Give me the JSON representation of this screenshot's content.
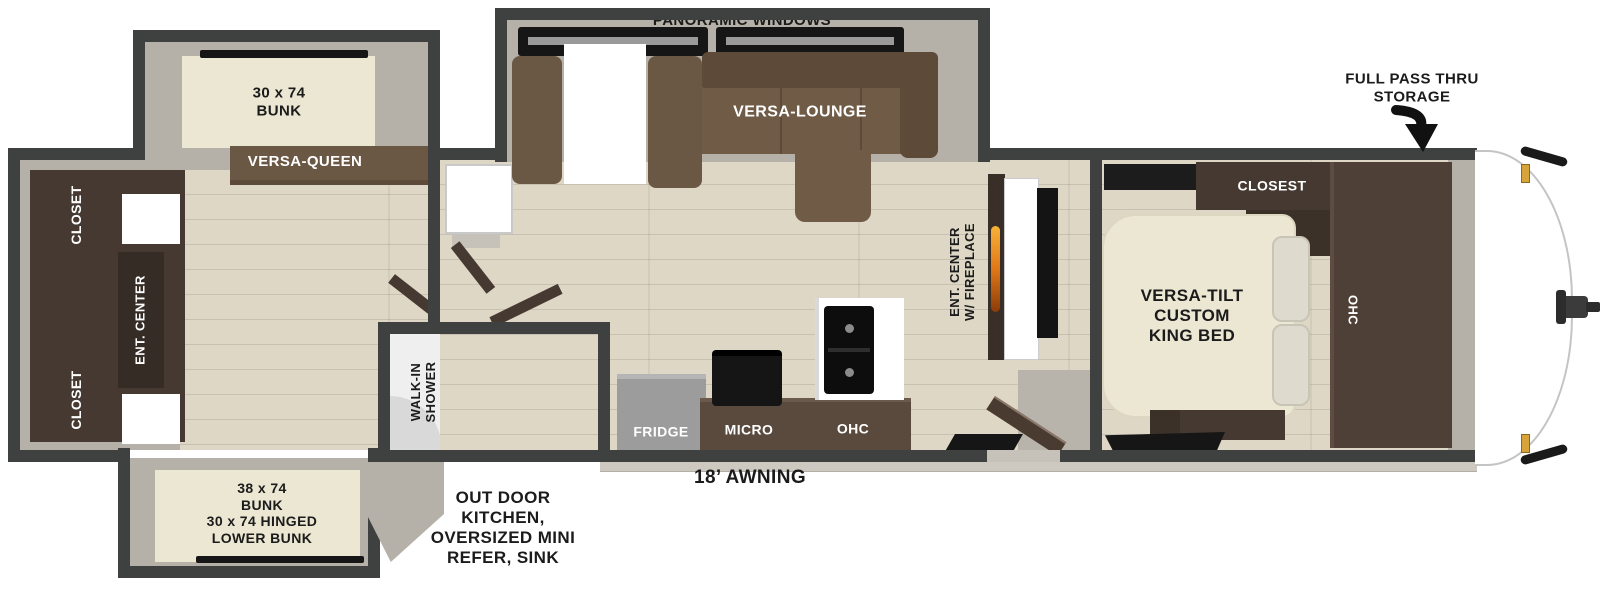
{
  "colors": {
    "wall": "#3f4040",
    "wallFace": "#b5b1a8",
    "floor": "#ded7c5",
    "cream": "#ece7d3",
    "brownDark": "#453931",
    "brown": "#55463b",
    "brownMid": "#6b5844",
    "sofa": "#6f5b46",
    "sofaDark": "#5d4a39",
    "applianceGray": "#9c9c9c",
    "black": "#161616",
    "glass": "#9fbdb2",
    "glassFill": "#e8efeb",
    "amber": "#d9a33c",
    "flameTop": "#f7b23a",
    "flameBottom": "#8a3c08",
    "textDark": "#1b1b1b",
    "threshold": "#c6c2b9",
    "hallFloor": "#b8b4ab",
    "awningBar": "#cdc9c0",
    "white": "#ffffff"
  },
  "annotations": {
    "full_pass_thru": "FULL PASS THRU\nSTORAGE",
    "awning": "18’ AWNING",
    "outdoor_kitchen": "OUT DOOR\nKITCHEN,\nOVERSIZED MINI\nREFER, SINK"
  },
  "rear_room": {
    "closet_top": "CLOSET",
    "ent_center": "ENT. CENTER",
    "closet_bottom": "CLOSET",
    "bunk_top": "30 x 74\nBUNK",
    "versa_queen": "VERSA-QUEEN",
    "bunk_bottom": "38 x 74\nBUNK\n30 x 74 HINGED\nLOWER BUNK"
  },
  "bathroom": {
    "walk_in_shower": "WALK-IN\nSHOWER"
  },
  "living_room": {
    "panoramic_windows": "PANORAMIC WINDOWS",
    "versa_lounge": "VERSA-LOUNGE",
    "ent_center_fireplace": "ENT. CENTER\nW/ FIREPLACE",
    "fridge": "FRIDGE",
    "micro": "MICRO",
    "ohc": "OHC"
  },
  "front_bedroom": {
    "closet": "CLOSEST",
    "bed": "VERSA-TILT\nCUSTOM\nKING BED",
    "ohc": "OHC"
  }
}
